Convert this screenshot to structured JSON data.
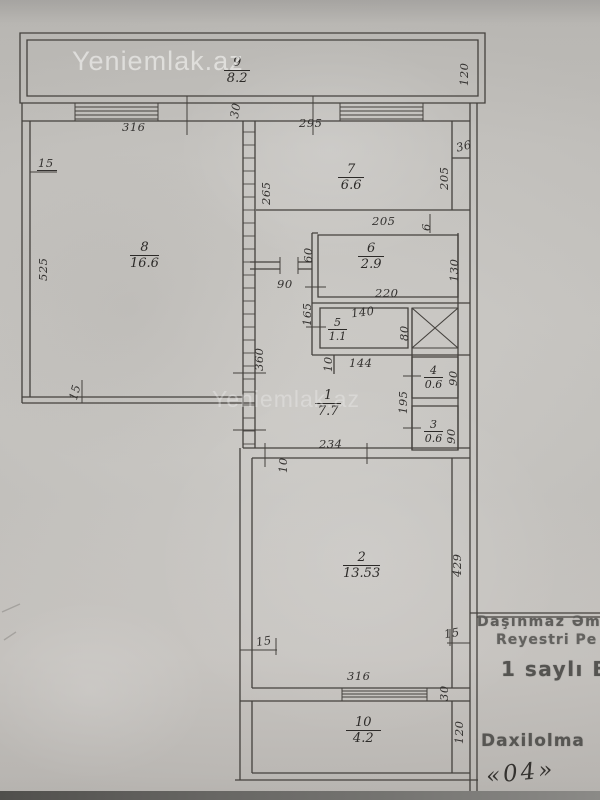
{
  "watermark": "Yeniemlak.az",
  "rooms": {
    "r9": {
      "num": "9",
      "area": "8.2"
    },
    "r8": {
      "num": "8",
      "area": "16.6"
    },
    "r7": {
      "num": "7",
      "area": "6.6"
    },
    "r6": {
      "num": "6",
      "area": "2.9"
    },
    "r5": {
      "num": "5",
      "area": "1.1"
    },
    "r4": {
      "num": "4",
      "area": "0.6"
    },
    "r3": {
      "num": "3",
      "area": "0.6"
    },
    "r1": {
      "num": "1",
      "area": "7.7"
    },
    "r2": {
      "num": "2",
      "area": "13.53"
    },
    "r10": {
      "num": "10",
      "area": "4.2"
    }
  },
  "dims": {
    "balcony9_right": "120",
    "wall30_top": "30",
    "room8_top": "316",
    "room8_left15": "15",
    "room8_left": "525",
    "room8_bottom15": "15",
    "room7_top": "295",
    "room7_left": "265",
    "room7_right": "205",
    "step36": "36",
    "room7_bottom": "205",
    "small6": "6",
    "room6_left": "60",
    "room6_right": "130",
    "room6_bottom": "220",
    "hall_door": "90",
    "room5_left": "165",
    "room5_top": "140",
    "room5_right": "80",
    "stub10": "10",
    "hall_bottom": "144",
    "room4_right": "90",
    "between43": "195",
    "room3_right": "90",
    "room1_bottom": "234",
    "wall360": "360",
    "room2_top10": "10",
    "room2_right": "429",
    "room2_b15_left": "15",
    "room2_b15_right": "15",
    "room2_bottom": "316",
    "wall30_bottom": "30",
    "room10_right": "120"
  },
  "stamp": {
    "line1": "Daşınmaz Əm",
    "line2": "Reyestri Pe",
    "line3": "1 saylı B",
    "line4": "Daxilolma",
    "handwritten": "«04»"
  },
  "colors": {
    "line": "#44413d",
    "paper": "#c9c7c3",
    "ink": "#2c2a28"
  }
}
